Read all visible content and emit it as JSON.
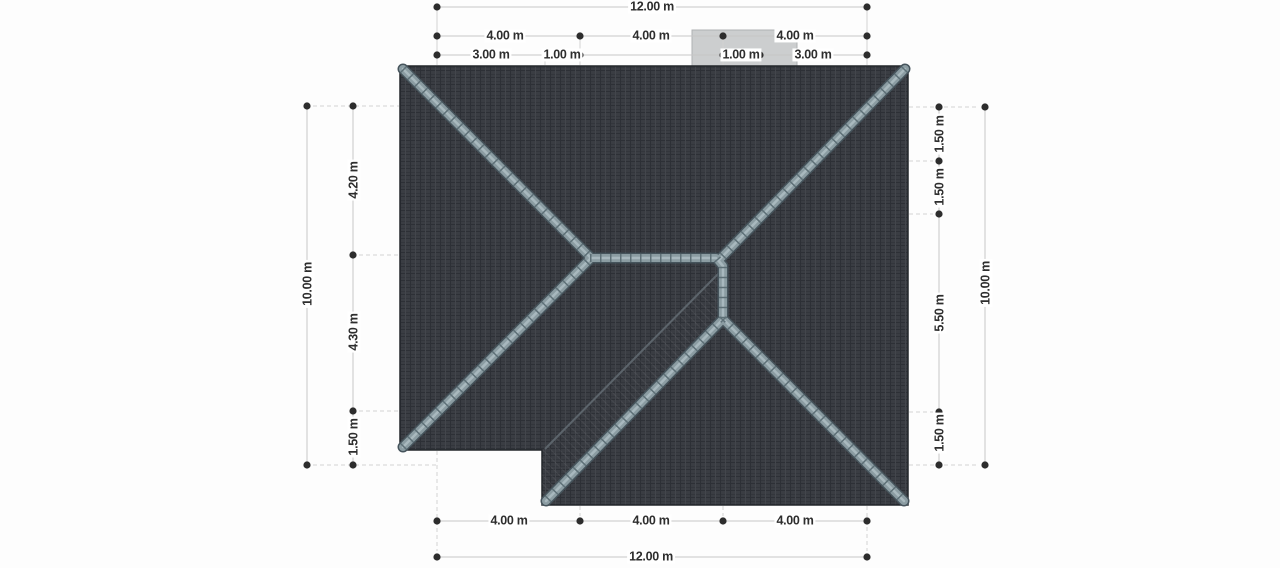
{
  "drawing": {
    "kind": "roof-plan-top-view",
    "units": "m"
  },
  "dims": {
    "top_overall": "12.00 m",
    "top_row2": [
      "4.00 m",
      "4.00 m",
      "4.00 m"
    ],
    "top_row3": [
      "3.00 m",
      "1.00 m",
      "1.00 m",
      "3.00 m"
    ],
    "bottom_segments": [
      "4.00 m",
      "4.00 m",
      "4.00 m"
    ],
    "bottom_overall": "12.00 m",
    "left_overall": "10.00 m",
    "left_segments": [
      "4.20 m",
      "4.30 m",
      "1.50 m"
    ],
    "right_segments": [
      "1.50 m",
      "1.50 m",
      "5.50 m",
      "1.50 m"
    ],
    "right_overall": "10.00 m"
  },
  "colors": {
    "roof_base": "#3a3d43",
    "roof_joint_dark": "#2d3036",
    "roof_joint_light": "#43464c",
    "ridge_outline": "#46545c",
    "ridge_cap": "#8b9ca2",
    "ridge_highlight": "#aebec3",
    "ridge_joint": "#5e7077",
    "valley_line": "#5c646b",
    "chimney_fill": "#cccecf",
    "chimney_border": "#aeb1b3",
    "dimension_line": "#c6c6c6",
    "extension_line": "#d2d2d2",
    "dimension_dot": "#2d2d2d",
    "dimension_text": "#2e2e2e"
  }
}
